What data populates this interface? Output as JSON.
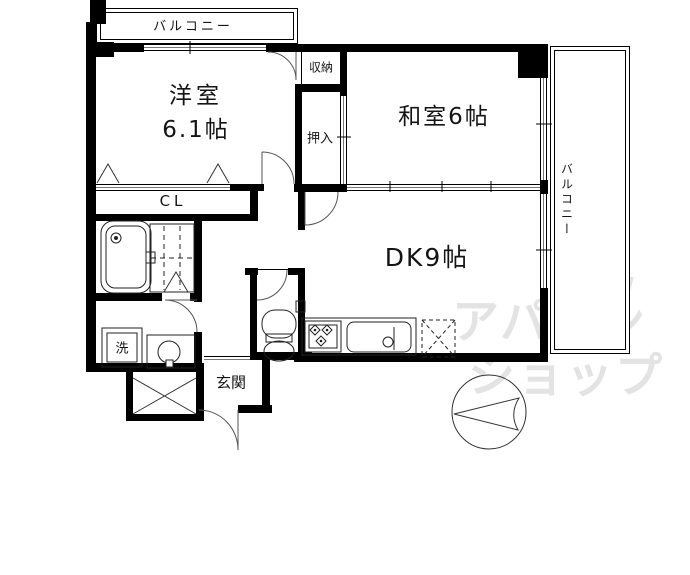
{
  "rooms": {
    "balcony_top": "バルコニー",
    "balcony_right": "バルコニー",
    "western_room_name": "洋室",
    "western_room_size": "6.1帖",
    "japanese_room": "和室6帖",
    "dining_kitchen": "DK9帖",
    "storage": "収納",
    "closet_oshiire": "押入",
    "closet_cl": "CL",
    "laundry": "洗",
    "entrance": "玄関"
  },
  "watermark": {
    "line1": "アパマン",
    "line2": "ショップ",
    "accent1": "w",
    "accent2": "L"
  },
  "colors": {
    "line": "#000000",
    "door_arc": "#555555",
    "watermark": "#e3e3e3",
    "background": "#ffffff"
  }
}
